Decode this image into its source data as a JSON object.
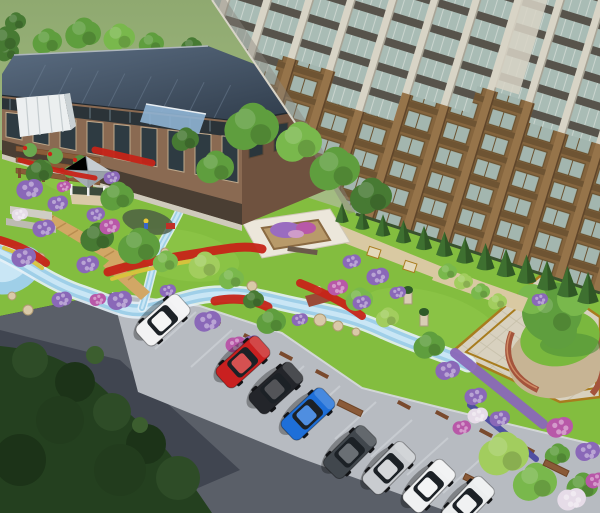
{
  "meta": {
    "description": "Aerial 3D architectural rendering of a residential community: high-rise apartment tower, clubhouse with dark solar roof, landscaped garden with winding stream, flower beds, pergola, gazebo, paved plaza with central tree, and a road with angled parked cars",
    "label": "landscape-rendering"
  },
  "palette": {
    "background_green": "#97b277",
    "background_green_light": "#aec68b",
    "lawn": "#83bd3f",
    "lawn_light": "#97ce52",
    "lawn_dark": "#6da832",
    "road": "#5a5f68",
    "road_shadow": "#3c414c",
    "parking_strip": "#b7bbc1",
    "stall_line": "#ced2d7",
    "curb": "#d8dbde",
    "tree_mass": "#24401f",
    "stream_water": "#9fcfe8",
    "stream_bank": "#e6f1f7",
    "stream_light": "#c9e6f5",
    "tower_glass": "#a9bcb5",
    "tower_column": "#d8d4c6",
    "tower_brown": "#8a6a42",
    "tower_brown_light": "#96744a",
    "tower_spandrel": "#57534b",
    "brick": "#8a6a52",
    "brick_dark": "#6f523f",
    "roof_slate": "#45566a",
    "roof_slate_dark": "#2c3846",
    "gazebo_roof": "#c6ccd1",
    "pergola_wood": "#8a5c38",
    "boardwalk": "#d2a765",
    "plaza_paving": "#d8d1bf",
    "plaza_border": "#a87c1e",
    "plaza_pebble": "#c7b494",
    "plaza_brick": "#a4543c",
    "gravel_path": "#d9c9a2",
    "flower_red": "#c62418",
    "flower_yellow": "#d8c33c",
    "flower_purple": "#8a68b8",
    "flower_magenta": "#b858a8",
    "flower_pink": "#cf9cc9",
    "flower_white": "#e6dce8",
    "tree_green": "#5f9e3e",
    "tree_green_light": "#79b84c",
    "tree_green_dark": "#477a33",
    "tree_yellow_green": "#a2cd5e",
    "hedge_cone": "#3e7030",
    "car_glass": "#1c2126",
    "car_wheel": "#141518"
  },
  "vegetation": {
    "tree_colors": [
      "tree_green",
      "tree_green_light",
      "tree_green_dark",
      "tree_yellow_green"
    ],
    "background_trees": [
      [
        48,
        42,
        14,
        0
      ],
      [
        84,
        34,
        17,
        0
      ],
      [
        120,
        38,
        15,
        1
      ],
      [
        152,
        44,
        12,
        0
      ],
      [
        192,
        47,
        10,
        2
      ],
      [
        8,
        52,
        11,
        2
      ],
      [
        6,
        40,
        14,
        2
      ],
      [
        16,
        22,
        10,
        2
      ]
    ],
    "trees": [
      [
        253,
        128,
        26,
        0
      ],
      [
        300,
        143,
        22,
        1
      ],
      [
        336,
        170,
        24,
        0
      ],
      [
        372,
        197,
        20,
        2
      ],
      [
        216,
        168,
        18,
        0
      ],
      [
        186,
        140,
        13,
        2
      ],
      [
        40,
        172,
        13,
        2
      ],
      [
        118,
        197,
        16,
        0
      ],
      [
        98,
        238,
        16,
        2
      ],
      [
        140,
        247,
        20,
        0
      ],
      [
        166,
        262,
        12,
        1
      ],
      [
        205,
        266,
        15,
        3
      ],
      [
        232,
        279,
        12,
        1
      ],
      [
        272,
        322,
        14,
        0
      ],
      [
        254,
        300,
        10,
        2
      ],
      [
        360,
        300,
        13,
        1
      ],
      [
        388,
        318,
        11,
        3
      ],
      [
        430,
        346,
        15,
        0
      ],
      [
        448,
        272,
        9,
        1
      ],
      [
        464,
        282,
        9,
        3
      ],
      [
        481,
        292,
        9,
        1
      ],
      [
        498,
        302,
        9,
        3
      ],
      [
        505,
        455,
        24,
        3
      ],
      [
        536,
        483,
        21,
        1
      ],
      [
        583,
        487,
        15,
        0
      ],
      [
        558,
        455,
        12,
        0
      ]
    ],
    "shrubs": [
      [
        30,
        190,
        13,
        "p"
      ],
      [
        58,
        204,
        10,
        "p"
      ],
      [
        20,
        215,
        8,
        "w"
      ],
      [
        44,
        229,
        11,
        "p"
      ],
      [
        96,
        215,
        9,
        "p"
      ],
      [
        110,
        227,
        10,
        "m"
      ],
      [
        24,
        258,
        12,
        "p"
      ],
      [
        62,
        300,
        10,
        "p"
      ],
      [
        88,
        265,
        11,
        "p"
      ],
      [
        120,
        301,
        12,
        "p"
      ],
      [
        98,
        300,
        8,
        "m"
      ],
      [
        168,
        291,
        8,
        "p"
      ],
      [
        208,
        322,
        13,
        "p"
      ],
      [
        236,
        345,
        10,
        "m"
      ],
      [
        252,
        342,
        8,
        "p"
      ],
      [
        338,
        288,
        10,
        "m"
      ],
      [
        362,
        303,
        9,
        "p"
      ],
      [
        352,
        262,
        9,
        "p"
      ],
      [
        378,
        277,
        11,
        "p"
      ],
      [
        398,
        293,
        8,
        "p"
      ],
      [
        448,
        371,
        12,
        "p"
      ],
      [
        476,
        397,
        11,
        "p"
      ],
      [
        500,
        419,
        10,
        "p"
      ],
      [
        462,
        428,
        9,
        "m"
      ],
      [
        478,
        416,
        10,
        "w"
      ],
      [
        560,
        428,
        13,
        "m"
      ],
      [
        588,
        452,
        12,
        "p"
      ],
      [
        572,
        500,
        14,
        "w"
      ],
      [
        596,
        481,
        10,
        "m"
      ],
      [
        112,
        178,
        8,
        "p"
      ],
      [
        64,
        187,
        7,
        "m"
      ],
      [
        540,
        300,
        8,
        "p"
      ],
      [
        300,
        320,
        8,
        "p"
      ]
    ],
    "hedge_cones": {
      "x1": 342,
      "y1": 218,
      "x2": 588,
      "y2": 296,
      "count": 13
    }
  },
  "flower_strips": [
    {
      "d": "M108,272 C140,262 170,258 205,252 C230,248 245,245 262,249",
      "c": "flower_red",
      "w": 9
    },
    {
      "d": "M112,279 C142,269 172,264 204,259",
      "c": "flower_yellow",
      "w": 4
    },
    {
      "d": "M95,150 L152,163",
      "c": "flower_red",
      "w": 7
    },
    {
      "d": "M0,240 C20,246 32,252 46,263",
      "c": "flower_red",
      "w": 8
    },
    {
      "d": "M4,248 C18,253 30,259 42,268",
      "c": "flower_yellow",
      "w": 4
    },
    {
      "d": "M215,301 C235,297 252,299 268,307",
      "c": "flower_red",
      "w": 9
    },
    {
      "d": "M300,283 C325,293 345,303 362,316",
      "c": "flower_red",
      "w": 8
    },
    {
      "d": "M455,353 C485,377 515,401 543,424",
      "c": "flower_purple",
      "w": 10
    },
    {
      "d": "M470,405 C494,424 516,442 536,459",
      "c": "#4a4aa0",
      "w": 6
    },
    {
      "d": "M20,160 C45,168 70,174 95,178",
      "c": "flower_red",
      "w": 5
    }
  ],
  "vehicles": [
    {
      "name": "white-hatchback",
      "color": "#f2f2f3",
      "x": 163,
      "y": 320,
      "angle": 138
    },
    {
      "name": "red-sedan",
      "color": "#c92020",
      "x": 243,
      "y": 362,
      "angle": 138
    },
    {
      "name": "black-sedan",
      "color": "#23252a",
      "x": 276,
      "y": 388,
      "angle": 138
    },
    {
      "name": "blue-sedan",
      "color": "#1e6fd8",
      "x": 308,
      "y": 414,
      "angle": 137
    },
    {
      "name": "gray-sedan",
      "color": "#41474d",
      "x": 350,
      "y": 452,
      "angle": 135
    },
    {
      "name": "silver-sedan",
      "color": "#c9ccd0",
      "x": 389,
      "y": 468,
      "angle": 135
    },
    {
      "name": "white-sedan",
      "color": "#f0f1f2",
      "x": 429,
      "y": 486,
      "angle": 134
    },
    {
      "name": "white-suv",
      "color": "#eceeef",
      "x": 468,
      "y": 503,
      "angle": 134
    }
  ],
  "parking": {
    "stall_lines": [
      [
        196,
        312
      ],
      [
        232,
        330
      ],
      [
        268,
        348
      ],
      [
        304,
        366
      ],
      [
        340,
        386
      ],
      [
        376,
        402
      ],
      [
        412,
        420
      ],
      [
        448,
        438
      ],
      [
        484,
        456
      ]
    ],
    "stall_dir": [
      -41,
      37
    ],
    "wheel_stops": [
      [
        214,
        321
      ],
      [
        250,
        338
      ],
      [
        286,
        356
      ],
      [
        322,
        374
      ],
      [
        404,
        405
      ],
      [
        442,
        415
      ],
      [
        486,
        433
      ],
      [
        528,
        449
      ]
    ],
    "wall_segments": [
      [
        350,
        408
      ],
      [
        476,
        482
      ],
      [
        556,
        468
      ]
    ]
  },
  "plaza_grid": {
    "a": {
      "x0": 452,
      "y0": 352,
      "x1": 540,
      "y1": 276,
      "dx": 14.5,
      "dy": 12.2,
      "n": 11
    },
    "b": {
      "x0": 540,
      "y0": 276,
      "x1": 612,
      "y1": 326,
      "dx": -9.9,
      "dy": 8.5,
      "n": 12
    }
  },
  "lowrise_windows": {
    "front_count": 9,
    "front_start": 14,
    "front_step": 27,
    "front_w": 16,
    "side_count": 4,
    "side_start": 256,
    "side_step": 25,
    "side_w": 14,
    "clerestory_mullions": 12
  },
  "roof_panel_lines": 8
}
